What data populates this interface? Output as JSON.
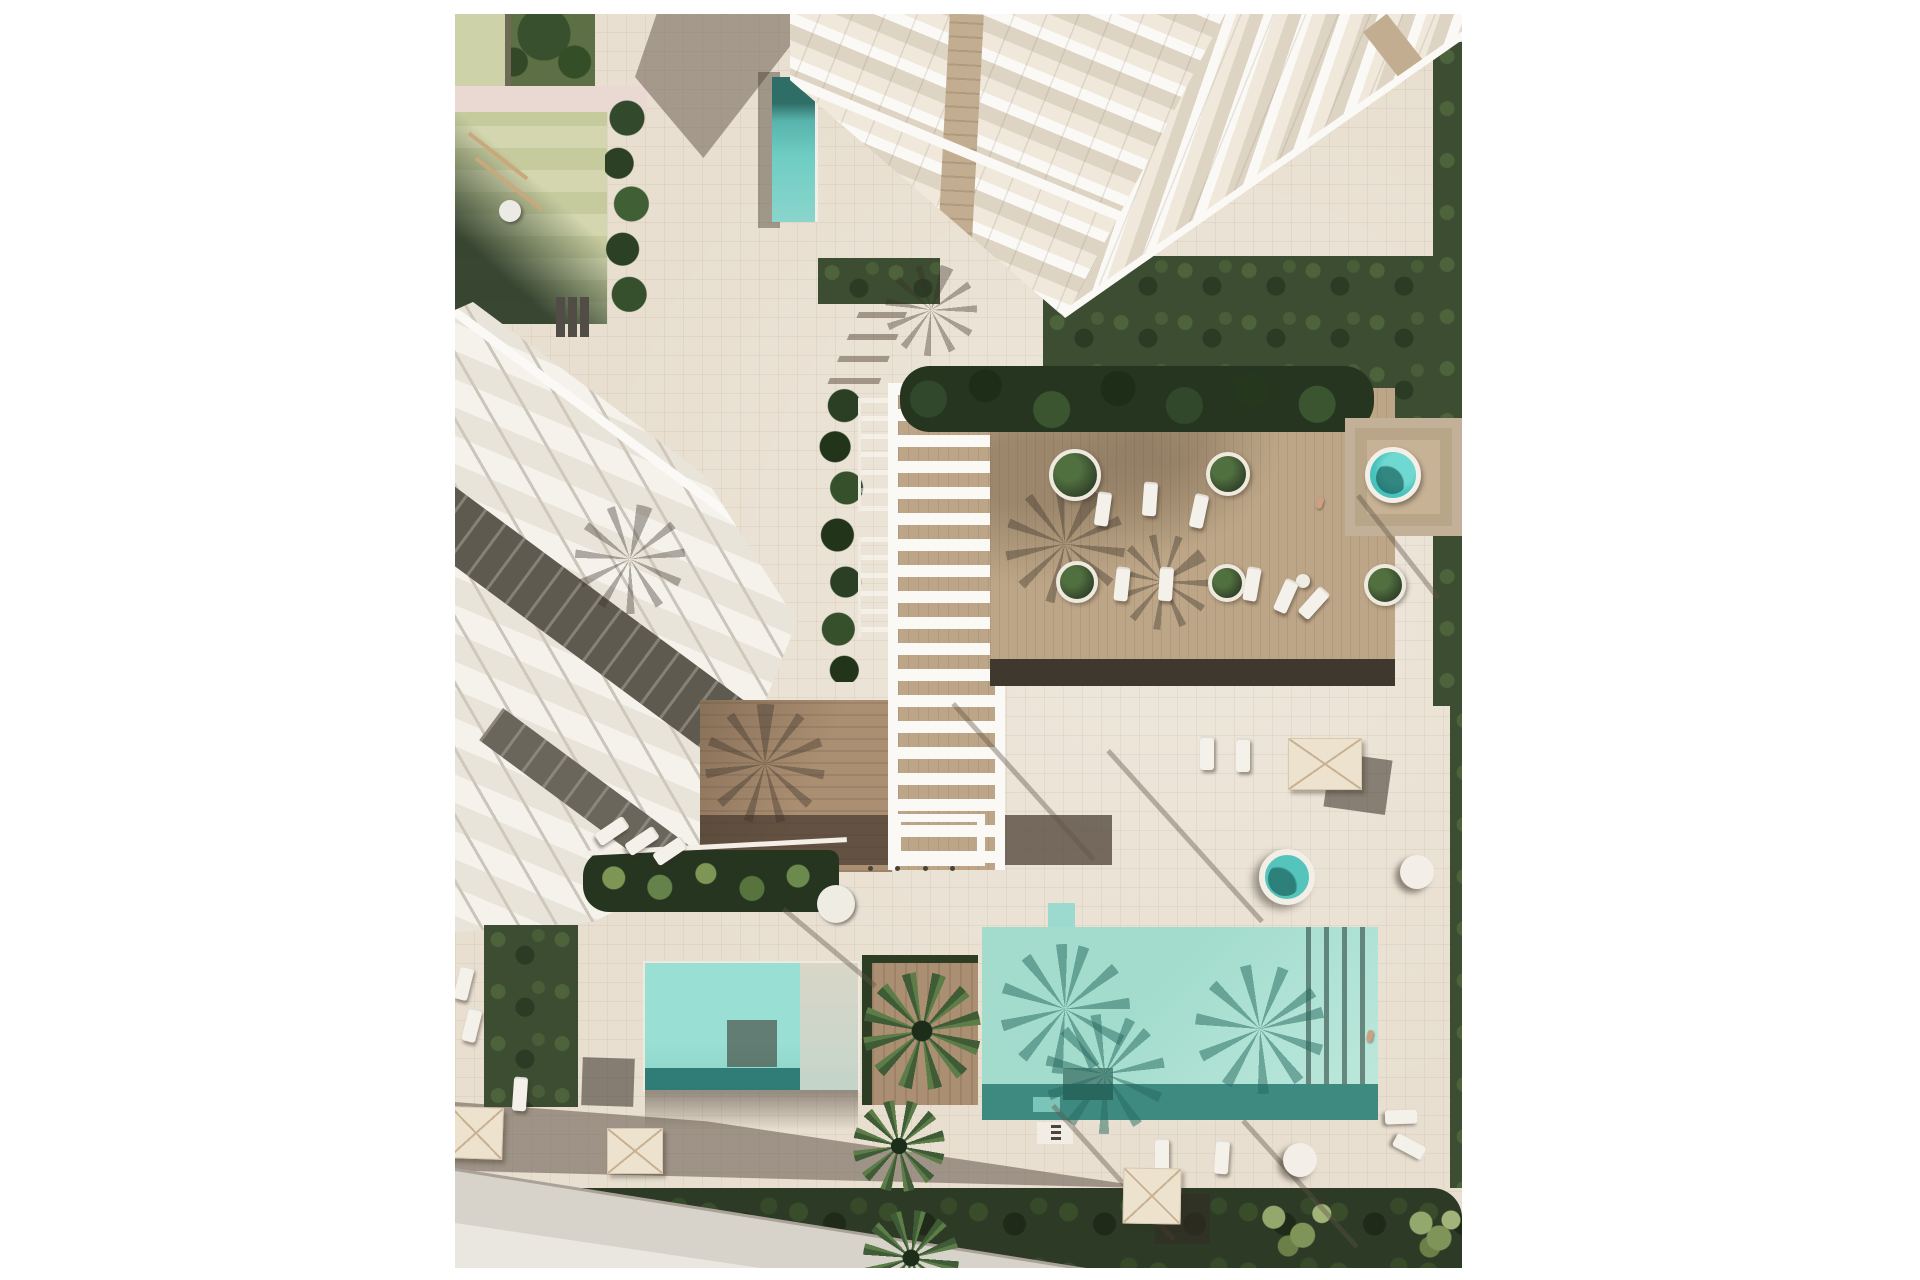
{
  "meta": {
    "title": "Aerial top-down architectural rendering of a resort residence: white apartment tower, terraced townhouses, pergola walkway, wooden lounge deck and turquoise swimming pools",
    "view": "top-down 3D render, afternoon sun casting long palm shadows toward the south-west"
  },
  "palette": {
    "paving": "#e8dfd0",
    "road": "#d8d3ca",
    "road-light": "#eae7e1",
    "kerb": "#aaa298",
    "grass-dark": "#2c3a26",
    "grass-mid": "#3c4d32",
    "deck": "#bda687",
    "bridge": "#ab8f72",
    "bldg": "#f5f2ec",
    "slab": "#fbf9f5",
    "glass": "#ddd4c4",
    "recess": "#5e5a50",
    "recess2": "#6a665b",
    "tan": "#c3ad90",
    "platform": "#c7b295",
    "umbrella": "#ece2cd",
    "umbrella-line": "#c9b193",
    "lounger": "#f4f1ea",
    "pg-light": "#d3d6ae",
    "pg-mid": "#c6cb9e",
    "frame": "#ced2a9",
    "path-pink": "#e9d9d2",
    "spa": "#49c2bd",
    "pool-teal": "#a7decf",
    "pool-teal-deep": "#3e8a80"
  },
  "regions": {
    "playground": "children playground with olive safety mat, swing frame and benches",
    "tower": "white high-rise with stepped glass balconies forming a chevron",
    "townhouses": "diagonal row of white terraced townhouses with recessed dark balconies",
    "pergola": "white slatted pergola over a boardwalk flanked by two lap-pool basins",
    "deck": "raised timber lounge deck with round planters, loungers and a spa pool",
    "big_pool": "main swimming pool with palm shadows on the water",
    "small_pool": "secondary pool with submerged shelf",
    "road": "street pavement at the lower-left corner"
  },
  "elements": {
    "planters": [
      {
        "name": "round-planter",
        "x": 594,
        "y": 435,
        "d": 52
      },
      {
        "name": "round-planter",
        "x": 751,
        "y": 438,
        "d": 44
      },
      {
        "name": "round-planter",
        "x": 601,
        "y": 547,
        "d": 42
      },
      {
        "name": "round-planter",
        "x": 753,
        "y": 550,
        "d": 38
      },
      {
        "name": "round-planter",
        "x": 909,
        "y": 550,
        "d": 42
      }
    ],
    "circles": [
      {
        "name": "spa-pool",
        "cls": "c-spa",
        "x": 910,
        "y": 433,
        "d": 56
      },
      {
        "name": "jacuzzi-pool",
        "cls": "c-jacuzzi",
        "x": 804,
        "y": 835,
        "d": 56
      },
      {
        "name": "round-daybed",
        "cls": "c-white",
        "x": 945,
        "y": 841,
        "d": 34
      },
      {
        "name": "round-chair",
        "cls": "c-white",
        "x": 828,
        "y": 1129,
        "d": 34
      },
      {
        "name": "round-table-umbrella",
        "cls": "c-table",
        "x": 362,
        "y": 871,
        "d": 38
      },
      {
        "name": "side-table",
        "cls": "c-table",
        "x": 841,
        "y": 560,
        "d": 14
      }
    ],
    "loungers": [
      {
        "x": 641,
        "y": 478,
        "rot": 8
      },
      {
        "x": 688,
        "y": 468,
        "rot": 4
      },
      {
        "x": 737,
        "y": 480,
        "rot": 12
      },
      {
        "x": 660,
        "y": 553,
        "rot": 6
      },
      {
        "x": 704,
        "y": 553,
        "rot": 4
      },
      {
        "x": 790,
        "y": 553,
        "rot": 10
      },
      {
        "x": 824,
        "y": 565,
        "rot": 24
      },
      {
        "x": 852,
        "y": 572,
        "rot": 42
      },
      {
        "x": 150,
        "y": 800,
        "rot": 56
      },
      {
        "x": 180,
        "y": 810,
        "rot": 56
      },
      {
        "x": 208,
        "y": 820,
        "rot": 56
      },
      {
        "x": 745,
        "y": 722,
        "rot": 0
      },
      {
        "x": 781,
        "y": 724,
        "rot": 0
      },
      {
        "x": 2,
        "y": 952,
        "rot": 14
      },
      {
        "x": 10,
        "y": 994,
        "rot": 14
      },
      {
        "x": 58,
        "y": 1063,
        "rot": 4
      },
      {
        "x": 700,
        "y": 1124,
        "rot": 0
      },
      {
        "x": 760,
        "y": 1126,
        "rot": 4
      },
      {
        "x": 940,
        "y": 1086,
        "rot": 88
      },
      {
        "x": 948,
        "y": 1116,
        "rot": 118
      }
    ],
    "umbrellas": [
      {
        "x": -6,
        "y": 1093,
        "w": 54,
        "h": 52,
        "rot": 2
      },
      {
        "x": 152,
        "y": 1114,
        "w": 56,
        "h": 46,
        "rot": 0
      },
      {
        "x": 668,
        "y": 1154,
        "w": 58,
        "h": 56,
        "rot": 1
      },
      {
        "x": 833,
        "y": 724,
        "w": 74,
        "h": 52,
        "rot": 0
      }
    ],
    "shadow_squares": [
      {
        "x": 127,
        "y": 1044,
        "w": 52,
        "h": 48,
        "rot": 2
      },
      {
        "x": 272,
        "y": 1006,
        "w": 50,
        "h": 47,
        "rot": 0
      },
      {
        "x": 700,
        "y": 1180,
        "w": 55,
        "h": 50,
        "rot": 0
      },
      {
        "x": 872,
        "y": 742,
        "w": 62,
        "h": 55,
        "rot": 8
      }
    ],
    "bollards": [
      {
        "x": 413,
        "y": 852
      },
      {
        "x": 440,
        "y": 852
      },
      {
        "x": 468,
        "y": 852
      },
      {
        "x": 495,
        "y": 852
      }
    ],
    "palms": [
      {
        "name": "palm-tree",
        "x": 408,
        "y": 958,
        "d": 118,
        "rot": 10
      },
      {
        "name": "palm-tree",
        "x": 398,
        "y": 1086,
        "d": 92,
        "rot": 40
      },
      {
        "name": "palm-tree",
        "x": 408,
        "y": 1196,
        "d": 96,
        "rot": 64
      }
    ],
    "palm_shadows": [
      {
        "cls": "palm-shadow",
        "x": 120,
        "y": 490,
        "d": 110,
        "rot": 15
      },
      {
        "cls": "palm-shadow",
        "x": 550,
        "y": 470,
        "d": 120,
        "rot": 30
      },
      {
        "cls": "palm-shadow",
        "x": 660,
        "y": 520,
        "d": 96,
        "rot": 55
      },
      {
        "cls": "palm-shadow",
        "x": 250,
        "y": 690,
        "d": 120,
        "rot": 0
      },
      {
        "cls": "palm-shadow",
        "x": 430,
        "y": 250,
        "d": 92,
        "rot": 20
      },
      {
        "cls": "palm-shadow-teal",
        "x": 545,
        "y": 930,
        "d": 130,
        "rot": 12
      },
      {
        "cls": "palm-shadow-teal",
        "x": 590,
        "y": 1000,
        "d": 120,
        "rot": 40
      },
      {
        "cls": "palm-shadow-teal",
        "x": 740,
        "y": 950,
        "d": 130,
        "rot": 70
      }
    ],
    "trunk_shadows": [
      {
        "x": 500,
        "y": 688,
        "len": 210,
        "rot": 48
      },
      {
        "x": 655,
        "y": 735,
        "len": 230,
        "rot": 48
      },
      {
        "x": 600,
        "y": 1090,
        "len": 180,
        "rot": 48
      },
      {
        "x": 790,
        "y": 1105,
        "len": 170,
        "rot": 48
      },
      {
        "x": 330,
        "y": 893,
        "len": 120,
        "rot": 40
      },
      {
        "x": 905,
        "y": 480,
        "len": 130,
        "rot": 52
      }
    ],
    "persons": [
      {
        "name": "sunbather",
        "x": 862,
        "y": 483,
        "rot": 20
      },
      {
        "name": "swimmer",
        "x": 912,
        "y": 1016,
        "rot": 12
      }
    ]
  }
}
